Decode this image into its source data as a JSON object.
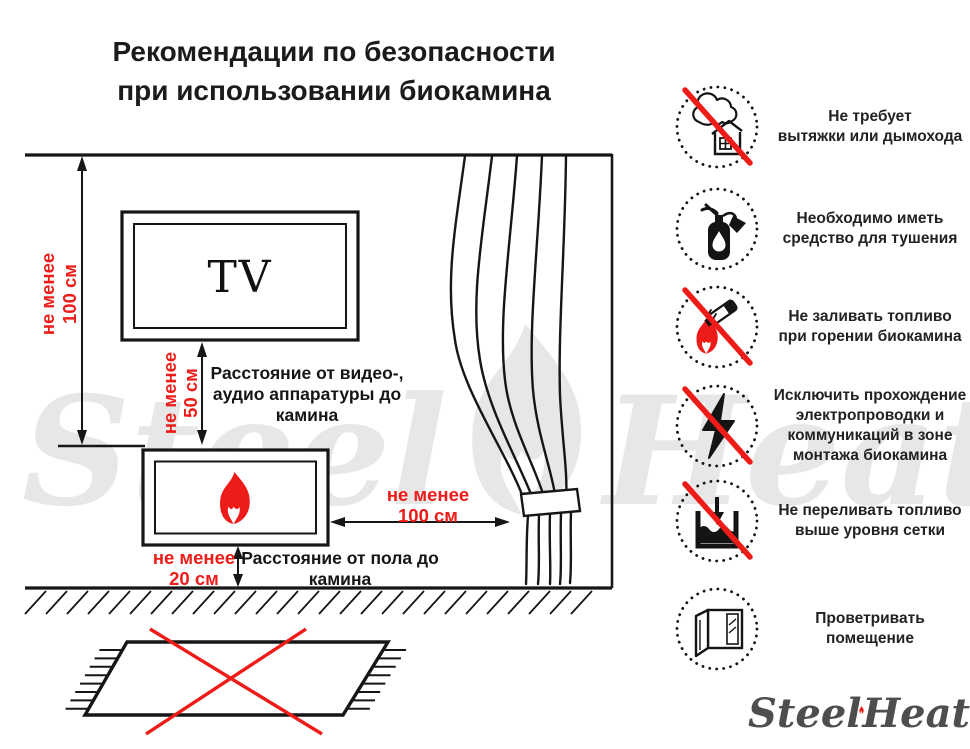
{
  "title": {
    "line1": "Рекомендации по безопасности",
    "line2": "при использовании биокамина"
  },
  "colors": {
    "red": "#ee1c18",
    "ink": "#161616",
    "watermark": "#e7e7e7",
    "logo_gray": "#4e4e4e"
  },
  "diagram": {
    "tv_label": "TV",
    "dim_wall": {
      "line1": "не менее",
      "line2": "100 см"
    },
    "dim_tv": {
      "line1": "не менее",
      "line2": "50 см"
    },
    "dim_curtain": {
      "line1": "не менее",
      "line2": "100 см"
    },
    "dim_floor": {
      "line1": "не менее",
      "line2": "20 см"
    },
    "caption_av": {
      "line1": "Расстояние от видео-,",
      "line2": "аудио аппаратуры до",
      "line3": "камина"
    },
    "caption_floor": {
      "line1": "Расстояние от пола до",
      "line2": "камина"
    }
  },
  "recommendations": [
    {
      "icon": "no-chimney-icon",
      "prohibited": true,
      "lines": [
        "Не требует",
        "вытяжки или дымохода"
      ]
    },
    {
      "icon": "extinguisher-icon",
      "prohibited": false,
      "lines": [
        "Необходимо иметь",
        "средство для тушения"
      ]
    },
    {
      "icon": "no-refuel-while-burning-icon",
      "prohibited": true,
      "lines": [
        "Не заливать топливо",
        "при горении биокамина"
      ]
    },
    {
      "icon": "no-wiring-icon",
      "prohibited": true,
      "lines": [
        "Исключить прохождение",
        "электропроводки и",
        "коммуникаций в зоне",
        "монтажа биокамина"
      ]
    },
    {
      "icon": "no-overfill-icon",
      "prohibited": true,
      "lines": [
        "Не переливать топливо",
        "выше уровня сетки"
      ]
    },
    {
      "icon": "ventilation-icon",
      "prohibited": false,
      "lines": [
        "Проветривать",
        "помещение"
      ]
    }
  ],
  "brand": {
    "watermark_left": "Steel",
    "watermark_right": "Heat",
    "logo_left": "Steel",
    "logo_right": "Heat"
  }
}
